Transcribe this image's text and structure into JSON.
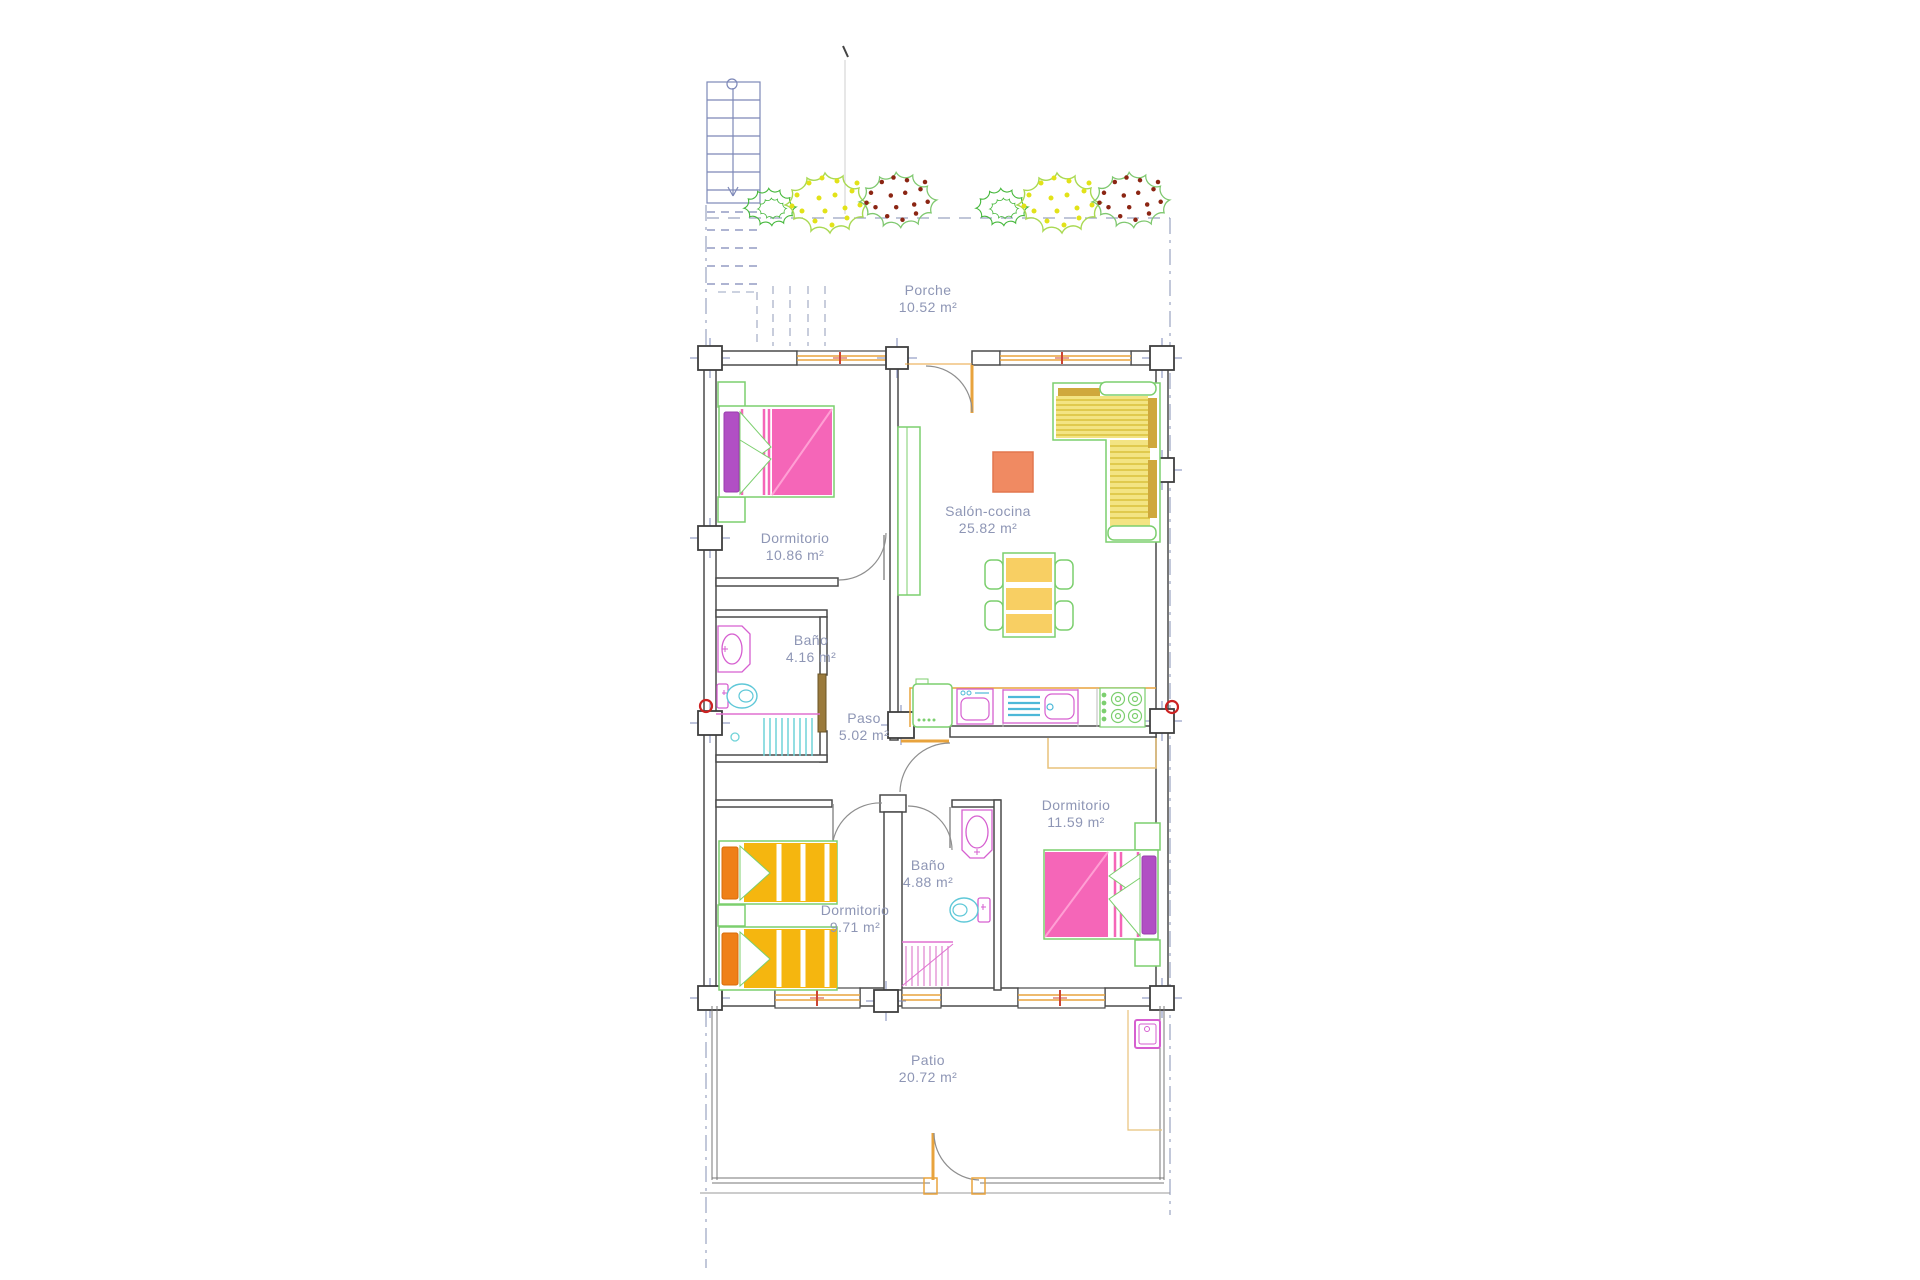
{
  "plan": {
    "title": "Apartment floor plan",
    "rooms": [
      {
        "id": "porche",
        "label": "Porche",
        "area": "10.52 m²"
      },
      {
        "id": "dormitorio-1",
        "label": "Dormitorio",
        "area": "10.86 m²"
      },
      {
        "id": "salon-cocina",
        "label": "Salón-cocina",
        "area": "25.82 m²"
      },
      {
        "id": "bano-1",
        "label": "Baño",
        "area": "4.16 m²"
      },
      {
        "id": "paso",
        "label": "Paso",
        "area": "5.02 m²"
      },
      {
        "id": "dormitorio-2",
        "label": "Dormitorio",
        "area": "11.59 m²"
      },
      {
        "id": "bano-2",
        "label": "Baño",
        "area": "4.88 m²"
      },
      {
        "id": "dormitorio-3",
        "label": "Dormitorio",
        "area": "9.71 m²"
      },
      {
        "id": "patio",
        "label": "Patio",
        "area": "20.72 m²"
      }
    ],
    "colors": {
      "wall": "#4a4a4a",
      "axis_blue": "#9aa4c0",
      "stairs_blue": "#7d88b8",
      "label_text": "#8e96b5",
      "window_orange": "#e8a33d",
      "wardrobe_orange": "#e8c27a",
      "furniture_green": "#7ccf6e",
      "bed_pink": "#f566b8",
      "pillow_purple": "#b14fc4",
      "bed_yellow": "#f5b60f",
      "pillow_orange": "#ef8018",
      "table_yellow": "#f8cf63",
      "sofa_yellow": "#f3e483",
      "sofa_olive": "#cfa83c",
      "rug_salmon": "#f08a62",
      "fixture_magenta": "#d65fd0",
      "fixture_cyan": "#5fc8d8",
      "shower_pink": "#e59ad8",
      "red_mark": "#cc4433",
      "bush_green": "#46b83c",
      "bush_yellow_dots": "#e2e218",
      "bush_red_dots": "#8b2513",
      "door_leaf_brown": "#9a7a3c"
    }
  }
}
